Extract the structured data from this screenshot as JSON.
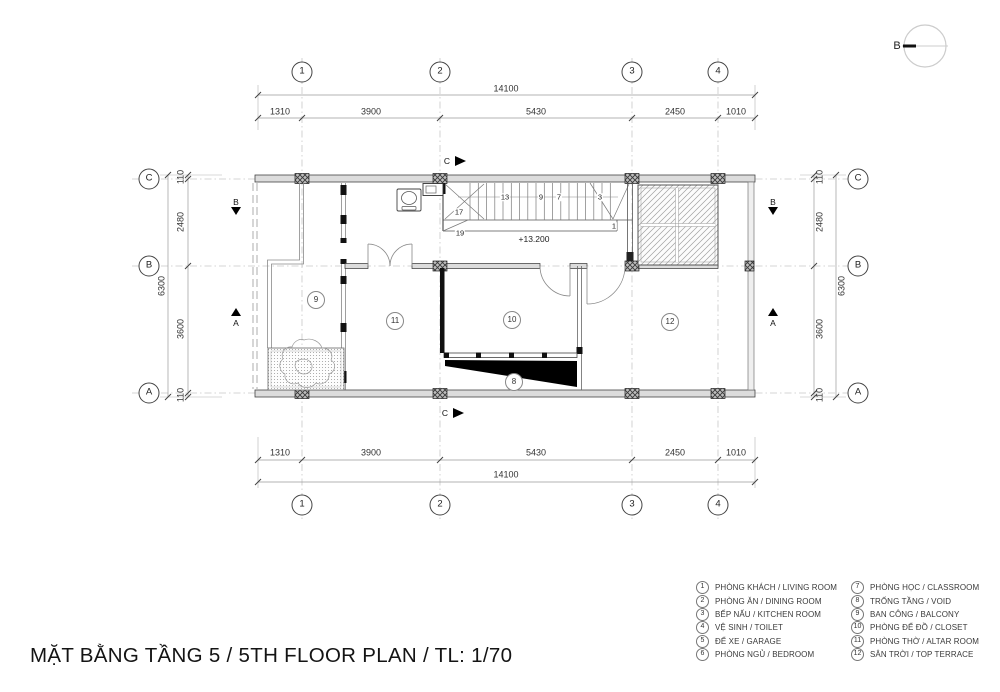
{
  "title": "MẶT BẰNG TẦNG 5 / 5TH FLOOR PLAN / TL: 1/70",
  "north": {
    "label": "B"
  },
  "grid": {
    "cols": [
      "1",
      "2",
      "3",
      "4"
    ],
    "rows": [
      "C",
      "B",
      "A"
    ]
  },
  "dimensions": {
    "horizontal": {
      "overall": "14100",
      "segments": [
        "1310",
        "3900",
        "5430",
        "2450",
        "1010"
      ]
    },
    "vertical": {
      "overall": "6300",
      "segments": [
        "110",
        "2480",
        "3600",
        "110"
      ]
    }
  },
  "sections": {
    "c": "C",
    "b": "B",
    "a": "A"
  },
  "stairs": {
    "treads": [
      "13",
      "9",
      "7",
      "3"
    ],
    "other": [
      "17",
      "19",
      "1"
    ],
    "level": "+13.200"
  },
  "rooms": [
    {
      "id": "balcony",
      "num": "9"
    },
    {
      "id": "altar-room",
      "num": "11"
    },
    {
      "id": "closet",
      "num": "10"
    },
    {
      "id": "void",
      "num": "8"
    },
    {
      "id": "top-terrace",
      "num": "12"
    }
  ],
  "legend": {
    "left": [
      {
        "num": "1",
        "label": "PHÒNG KHÁCH / LIVING ROOM"
      },
      {
        "num": "2",
        "label": "PHÒNG ĂN / DINING ROOM"
      },
      {
        "num": "3",
        "label": "BẾP NẤU / KITCHEN ROOM"
      },
      {
        "num": "4",
        "label": "VỆ SINH / TOILET"
      },
      {
        "num": "5",
        "label": "ĐỂ XE / GARAGE"
      },
      {
        "num": "6",
        "label": "PHÒNG NGỦ / BEDROOM"
      }
    ],
    "right": [
      {
        "num": "7",
        "label": "PHÒNG HỌC / CLASSROOM"
      },
      {
        "num": "8",
        "label": "TRỐNG TẦNG / VOID"
      },
      {
        "num": "9",
        "label": "BAN CÔNG / BALCONY"
      },
      {
        "num": "10",
        "label": "PHÒNG ĐỂ ĐỒ / CLOSET"
      },
      {
        "num": "11",
        "label": "PHÒNG THỜ / ALTAR ROOM"
      },
      {
        "num": "12",
        "label": "SÂN TRỜI / TOP TERRACE"
      }
    ]
  },
  "colors": {
    "wall_fill": "#dcdcdc",
    "line_dark": "#333333",
    "line_light": "#c8c8c8",
    "poche_black": "#111111"
  }
}
